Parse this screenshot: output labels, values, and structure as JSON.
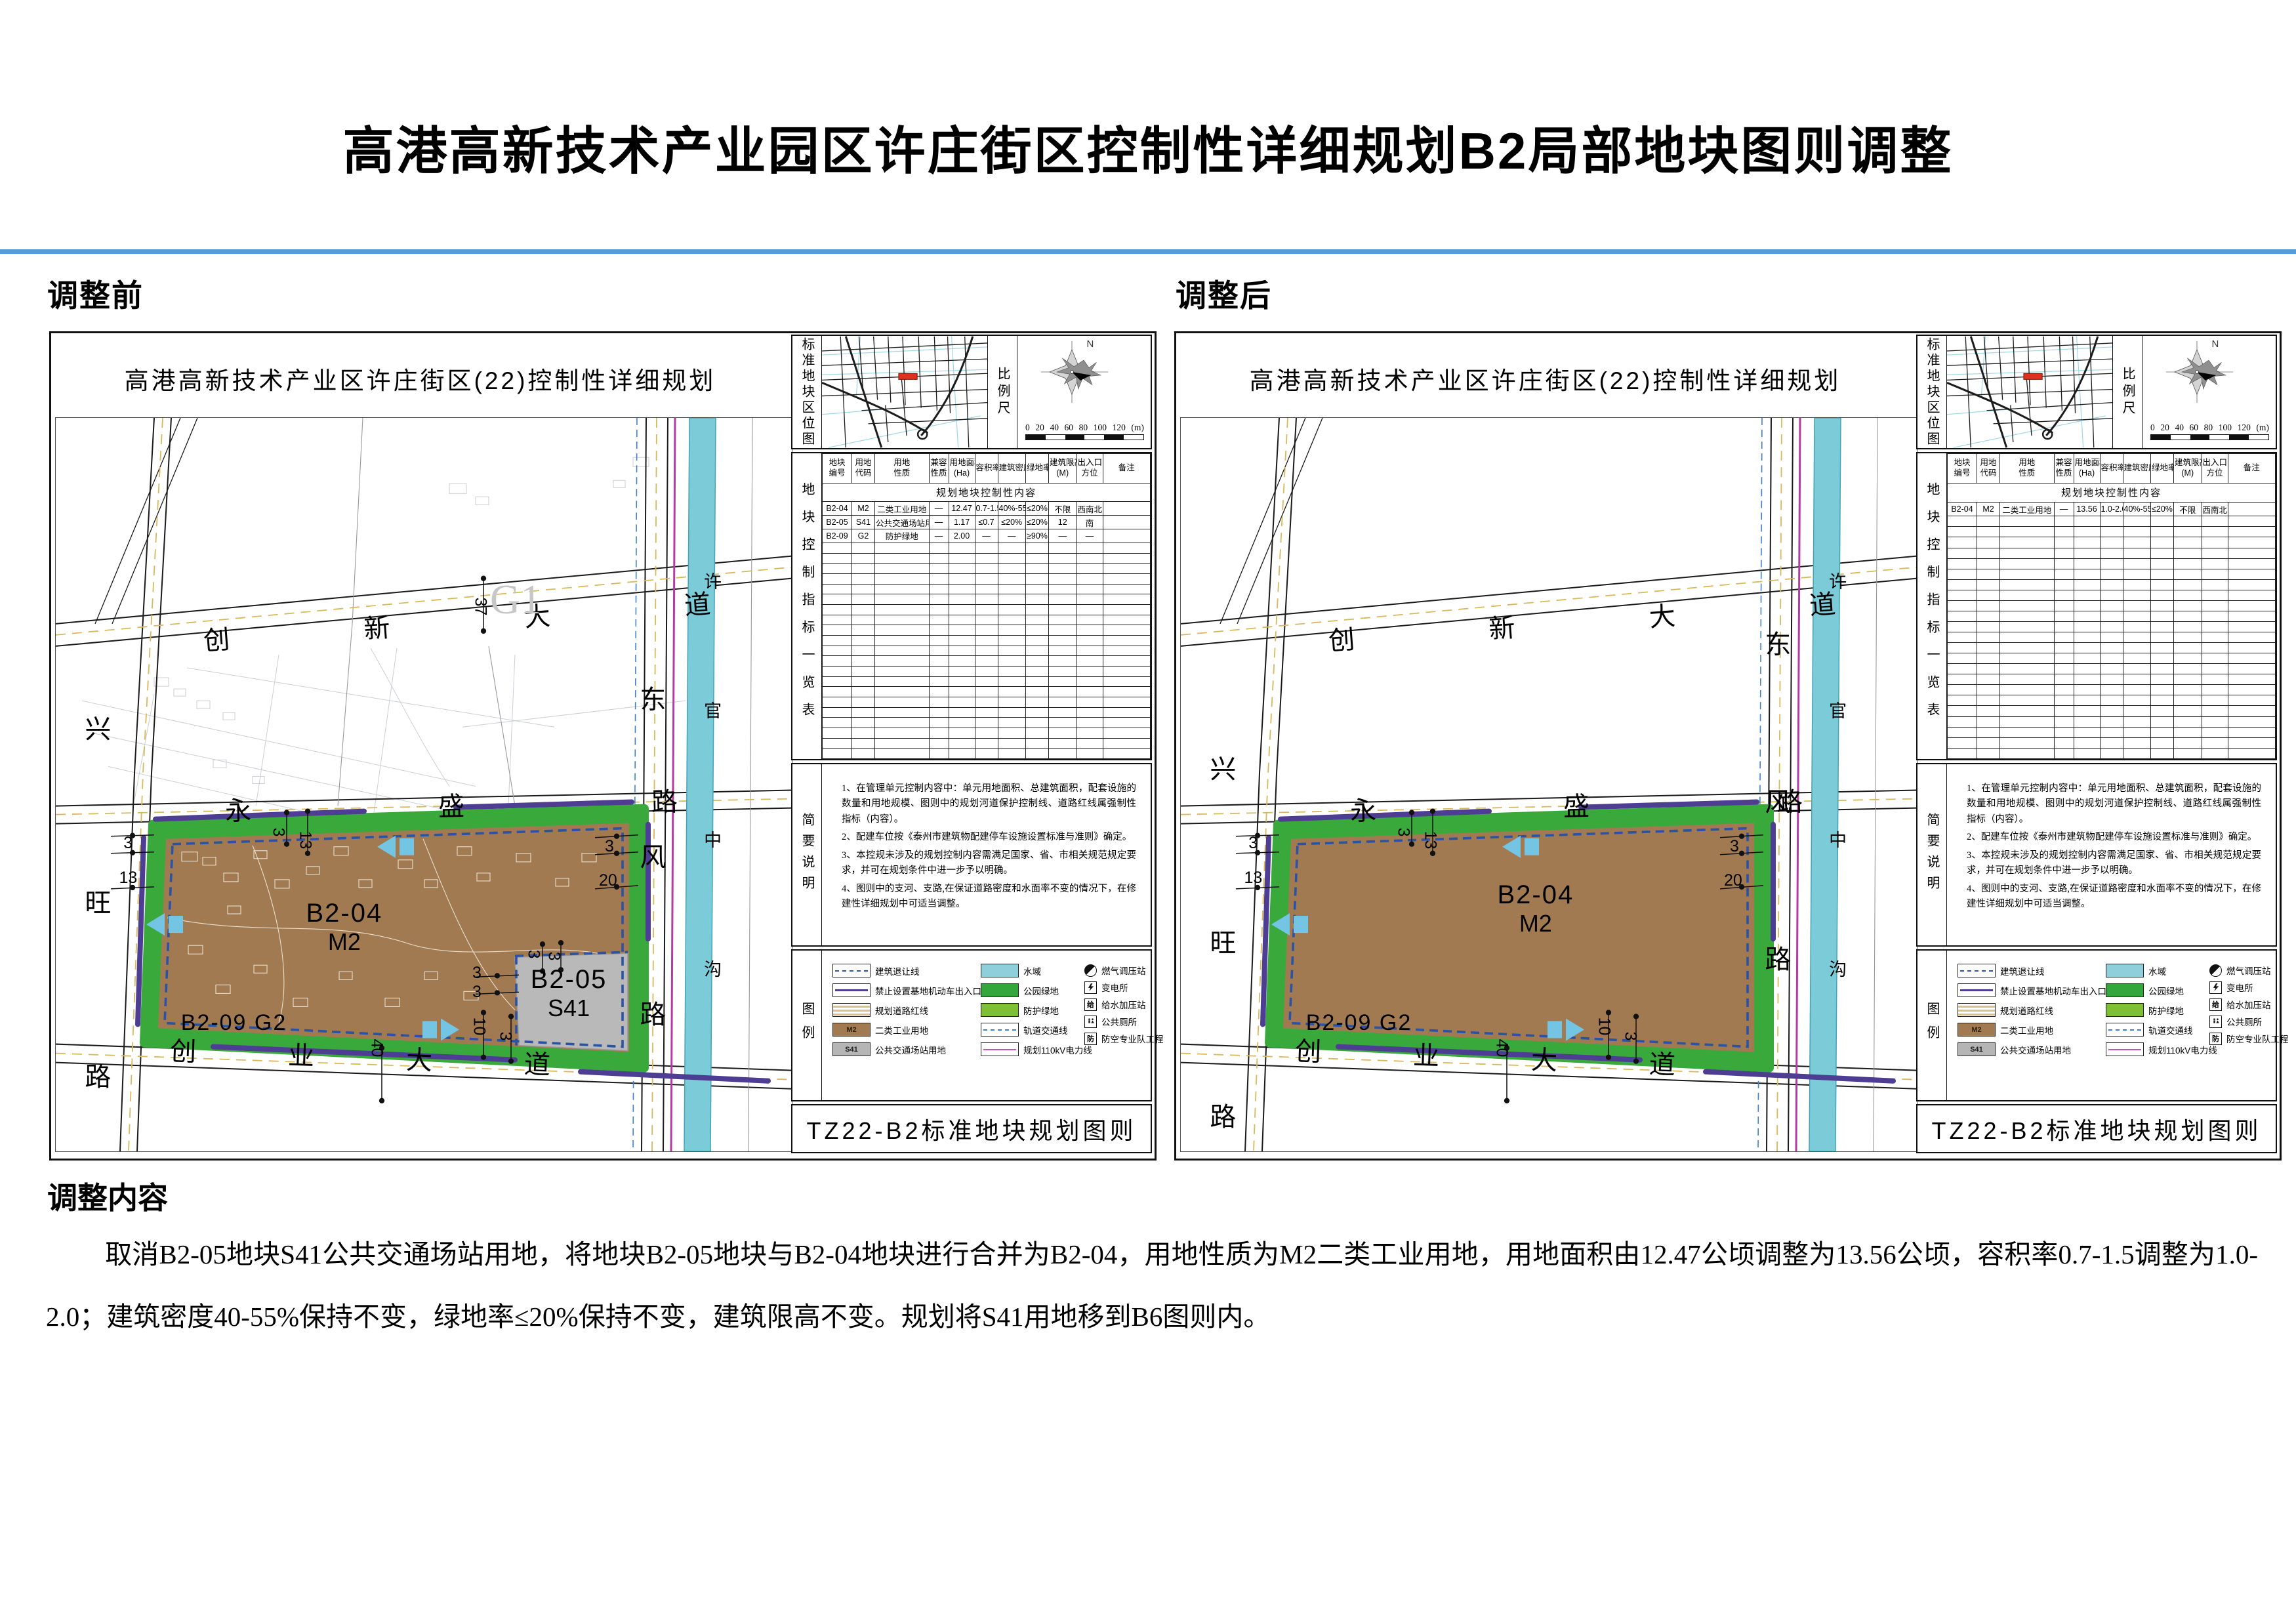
{
  "page": {
    "title": "高港高新技术产业园区许庄街区控制性详细规划B2局部地块图则调整",
    "section_before": "调整前",
    "section_after": "调整后",
    "adjust_heading": "调整内容",
    "adjust_text": "取消B2-05地块S41公共交通场站用地，将地块B2-05地块与B2-04地块进行合并为B2-04，用地性质为M2二类工业用地，用地面积由12.47公顷调整为13.56公顷，容积率0.7-1.5调整为1.0-2.0；建筑密度40-55%保持不变，绿地率≤20%保持不变，建筑限高不变。规划将S41用地移到B6图则内。"
  },
  "shared": {
    "locator_label": "标准地块区位图",
    "scale_label": "比例尺",
    "compass_n": "N",
    "scale_ticks": [
      "0",
      "20",
      "40",
      "60",
      "80",
      "100",
      "120",
      "(m)"
    ],
    "table_vertical_label": "地块控制指标一览表",
    "table_title": "规划地块控制性内容",
    "table_headers": [
      [
        "地块",
        "编号"
      ],
      [
        "用地",
        "代码"
      ],
      [
        "用地",
        "性质"
      ],
      [
        "兼容",
        "性质"
      ],
      [
        "用地面积",
        "(Ha)"
      ],
      [
        "容积率",
        ""
      ],
      [
        "建筑密度",
        ""
      ],
      [
        "绿地率",
        ""
      ],
      [
        "建筑限高",
        "(M)"
      ],
      [
        "出入口",
        "方位"
      ],
      [
        "备注",
        ""
      ]
    ],
    "notes_label": "简要说明",
    "notes": [
      "1、在管理单元控制内容中：单元用地面积、总建筑面积，配套设施的数量和用地规模、图则中的规划河道保护控制线、道路红线属强制性指标（内容）。",
      "2、配建车位按《泰州市建筑物配建停车设施设置标准与准则》确定。",
      "3、本控规未涉及的规划控制内容需满足国家、省、市相关规范规定要求，并可在规划条件中进一步予以明确。",
      "4、图则中的支河、支路,在保证道路密度和水面率不变的情况下，在修建性详细规划中可适当调整。"
    ],
    "legend_label": "图例",
    "legend": {
      "col1": [
        {
          "label": "建筑退让线"
        },
        {
          "label": "禁止设置基地机动车出入口范围"
        },
        {
          "label": "规划道路红线"
        },
        {
          "code": "M2",
          "label": "二类工业用地"
        },
        {
          "code": "S41",
          "label": "公共交通场站用地"
        }
      ],
      "col2": [
        {
          "label": "水域"
        },
        {
          "label": "公园绿地"
        },
        {
          "label": "防护绿地"
        },
        {
          "label": "轨道交通线"
        },
        {
          "label": "规划110kV电力线"
        }
      ],
      "col3": [
        {
          "label": "燃气调压站",
          "char": ""
        },
        {
          "label": "变电所",
          "char": ""
        },
        {
          "label": "给水加压站",
          "char": "给"
        },
        {
          "label": "公共厕所",
          "char": ""
        },
        {
          "label": "防空专业队工程",
          "char": "防"
        }
      ]
    },
    "sheet_title": "TZ22-B2标准地块规划图则",
    "colors": {
      "park_green": "#33a73c",
      "buffer_green": "#7fbf36",
      "water": "#8ecfdb",
      "industry_brown": "#a27a52",
      "transit_gray": "#b5b5b5",
      "setback_blue": "#2a52a5",
      "noaccess_purple": "#4d3d93",
      "power_magenta": "#c452b8",
      "accent_rule": "#5b9bd5"
    }
  },
  "panels": {
    "before": {
      "subtitle": "高港高新技术产业区许庄街区(22)控制性详细规划",
      "map": {
        "roads": {
          "top": "创新大道",
          "left": "兴旺路",
          "mid": "永盛路",
          "right": "东风路",
          "bottom": "创业大道",
          "river": "许官中沟"
        },
        "labels": {
          "main_block": "B2-04",
          "main_use": "M2",
          "green_belt": "B2-09 G2",
          "sub_block": "B2-05",
          "sub_use": "S41",
          "far_parcel": "G1"
        },
        "dims": {
          "left_a": "3",
          "left_b": "13",
          "top_a": "3",
          "top_b": "13",
          "right_a": "3",
          "right_b": "20",
          "bottom_a": "10",
          "bottom_b": "3",
          "road_bottom": "40",
          "road_top": "37",
          "s41_top_a": "3",
          "s41_top_b": "3",
          "s41_left_a": "3",
          "s41_left_b": "3"
        }
      },
      "table_rows": [
        [
          "B2-04",
          "M2",
          "二类工业用地",
          "—",
          "12.47",
          "0.7-1.5",
          "40%-55%",
          "≤20%",
          "不限",
          "西南北",
          ""
        ],
        [
          "B2-05",
          "S41",
          "公共交通场站用地",
          "—",
          "1.17",
          "≤0.7",
          "≤20%",
          "≤20%",
          "12",
          "南",
          ""
        ],
        [
          "B2-09",
          "G2",
          "防护绿地",
          "—",
          "2.00",
          "—",
          "—",
          "≥90%",
          "—",
          "—",
          ""
        ]
      ],
      "empty_rows": 21
    },
    "after": {
      "subtitle": "高港高新技术产业区许庄街区(22)控制性详细规划",
      "map": {
        "roads": {
          "top": "创新大道",
          "left": "兴旺路",
          "mid": "永盛路",
          "right": "东风路",
          "bottom": "创业大道",
          "river": "许官中沟"
        },
        "labels": {
          "main_block": "B2-04",
          "main_use": "M2",
          "green_belt": "B2-09 G2"
        },
        "dims": {
          "left_a": "3",
          "left_b": "13",
          "top_a": "3",
          "top_b": "13",
          "right_a": "3",
          "right_b": "20",
          "bottom_a": "10",
          "bottom_b": "3",
          "road_bottom": "40"
        }
      },
      "table_rows": [
        [
          "B2-04",
          "M2",
          "二类工业用地",
          "—",
          "13.56",
          "1.0-2.0",
          "40%-55%",
          "≤20%",
          "不限",
          "西南北",
          ""
        ]
      ],
      "empty_rows": 23
    }
  }
}
